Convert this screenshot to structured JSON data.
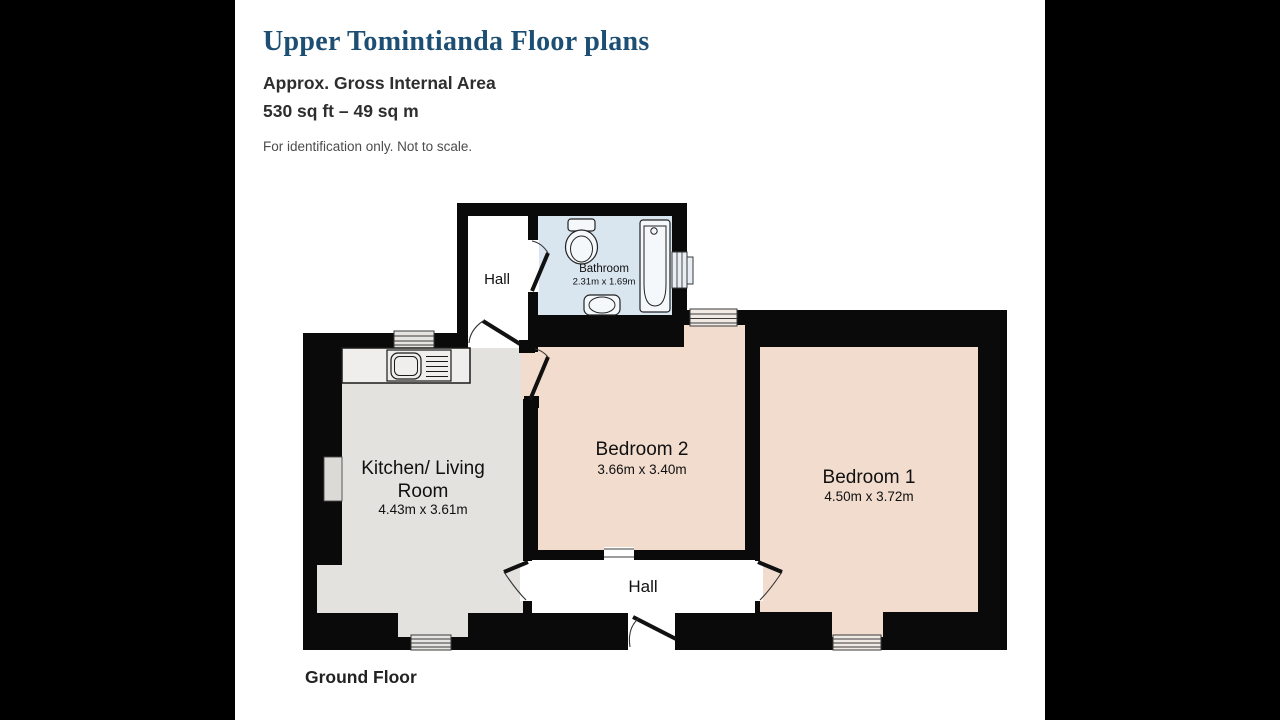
{
  "header": {
    "title": "Upper Tomintianda Floor plans",
    "subtitle": "Approx. Gross Internal Area",
    "area": "530 sq ft – 49 sq m",
    "disclaimer": "For identification only. Not to scale."
  },
  "floor": {
    "label": "Ground Floor"
  },
  "rooms": {
    "hall_top": {
      "name": "Hall"
    },
    "bathroom": {
      "name": "Bathroom",
      "dims": "2.31m x 1.69m"
    },
    "kitchen_living": {
      "name_lines": [
        "Kitchen/ Living",
        "Room"
      ],
      "dims": "4.43m x 3.61m"
    },
    "bedroom2": {
      "name": "Bedroom 2",
      "dims": "3.66m x 3.40m"
    },
    "bedroom1": {
      "name": "Bedroom 1",
      "dims": "4.50m x 3.72m"
    },
    "hall_bottom": {
      "name": "Hall"
    }
  },
  "colors": {
    "letterbox": "#000000",
    "title_text": "#1d4e73",
    "heading_text": "#2e2e2e",
    "disclaimer_text": "#4c4c4c",
    "wall": "#0a0a0a",
    "hall_fill": "#ffffff",
    "bathroom_fill": "#d9e5ef",
    "kitchen_fill": "#e4e2df",
    "bedroom_fill": "#f2dcce",
    "counter_fill": "#efeeec"
  }
}
